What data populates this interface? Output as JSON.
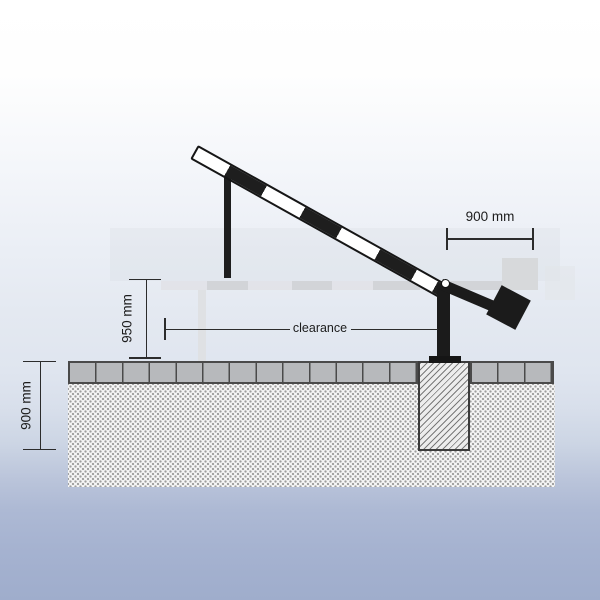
{
  "diagram": {
    "title": "Boom barrier vertical cross-section (raised position)",
    "labels": {
      "counterweight_width": "900 mm",
      "barrier_height": "950 mm",
      "foundation_depth": "900 mm",
      "clearance": "clearance"
    },
    "colors": {
      "barrier_black": "#1e1e1e",
      "barrier_white": "#ffffff",
      "dimension_line": "#2c2c2c",
      "paver_gray": "#b7b9bc",
      "soil_fill": "#f6f6f6",
      "foundation_fill": "#ededed",
      "ghost_gray": "#d2d4d8",
      "sky_top": "#ffffff",
      "sky_bottom": "#9fadcc"
    }
  }
}
